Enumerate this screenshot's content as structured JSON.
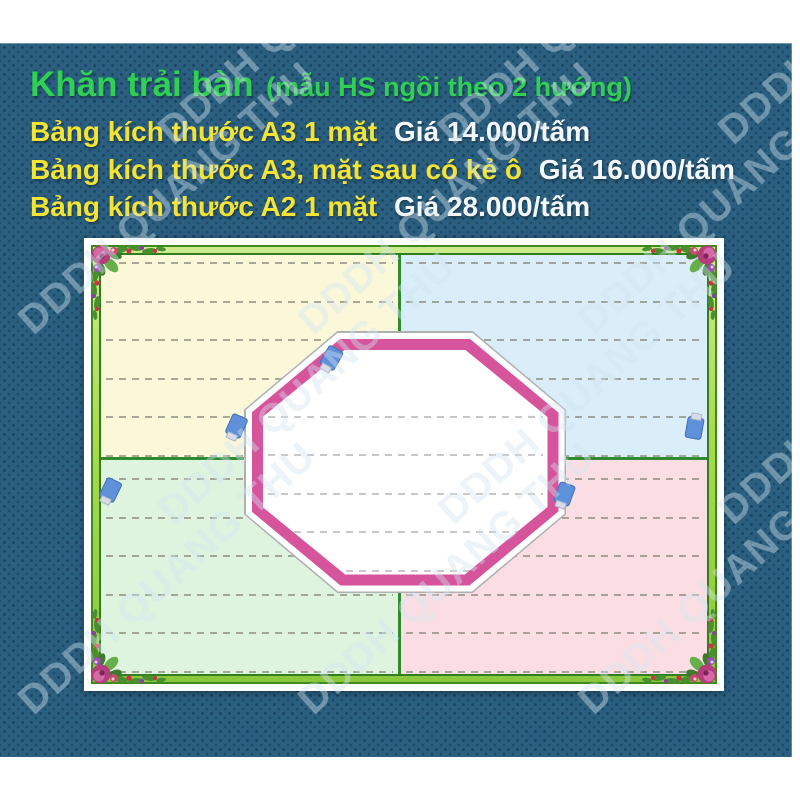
{
  "header": {
    "title": "Khăn trải bàn",
    "subtitle": "(mẫu HS ngồi theo 2 hướng)",
    "price_lines": [
      {
        "label": "Bảng kích thước A3 1 mặt",
        "price": "Giá 14.000/tấm"
      },
      {
        "label": "Bảng kích thước A3, mặt sau có kẻ ô",
        "price": "Giá 16.000/tấm"
      },
      {
        "label": "Bảng kích thước A2 1 mặt",
        "price": "Giá 28.000/tấm"
      }
    ]
  },
  "watermark": {
    "text": "DDDH QUANG THU"
  },
  "product_image": {
    "description": "tablecloth-sample-photo",
    "quadrants": [
      {
        "position": "top-left",
        "color": "#fbf8da"
      },
      {
        "position": "top-right",
        "color": "#d9eef8"
      },
      {
        "position": "bottom-left",
        "color": "#dff4df"
      },
      {
        "position": "bottom-right",
        "color": "#fbdee3"
      }
    ],
    "center_shape": "octagon",
    "icons": {
      "corner_decoration": "floral-bouquet-icon",
      "scattered_icon": "blue-marker-icon",
      "scattered_icon_count": 5
    }
  },
  "colors": {
    "panel_background": "#2b5f80",
    "title_green": "#2fd054",
    "label_yellow": "#f2e335",
    "price_white": "#f4f7f9",
    "frame_green": "#8cc83e",
    "frame_edge_green": "#3f8a1d",
    "octagon_border_pink": "#d5549b",
    "marker_blue": "#5f90da",
    "dashed_line_gray": "#8b8d7e"
  }
}
